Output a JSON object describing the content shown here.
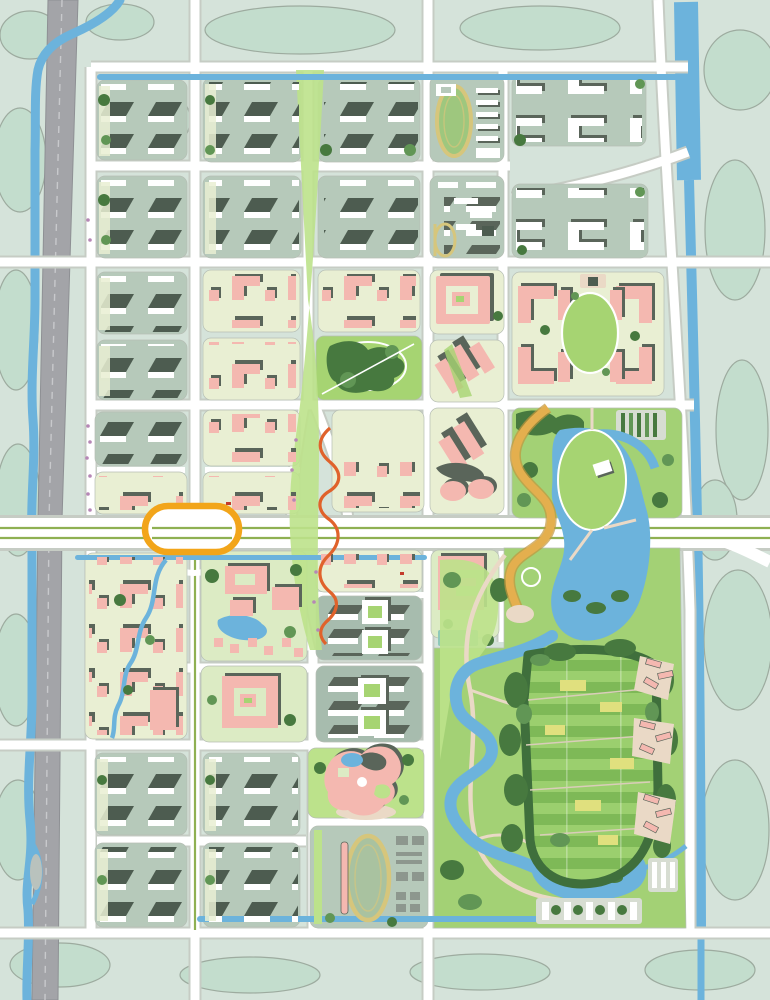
{
  "meta": {
    "title": "Urban district master plan — rendered site plan",
    "type": "site-plan map",
    "image_size": {
      "width": 770,
      "height": 1000
    },
    "visible_text": "none"
  },
  "palette": {
    "bg": "#d5e3da",
    "veg": "#c3ddcd",
    "vegline": "#9dab9f",
    "water": "#6cb3dc",
    "hwy": "#a3a4a8",
    "hwyDash": "#c8c9cc",
    "curb": "#c6ccc4",
    "groundSage": "#b6c9ba",
    "groundPale": "#e9efd3",
    "groundInd": "#a7bcae",
    "groundPark": "#a3d175",
    "groundCampus": "#dcebc4",
    "lawn": "#a6d472",
    "lawnL": "#bce28b",
    "canopy": "#47793f",
    "canopyL": "#619655",
    "slabDark": "#4d5c50",
    "shadow": "#5a655a",
    "pink": "#f4b8b0",
    "treeDark": "#2f4f2e",
    "treeOlive": "#9aa03b",
    "median": "#8fb052",
    "ring": "#f2a51a",
    "sroad": "#e4af4e",
    "sroadEdge": "#c2953c",
    "orange": "#e0622b",
    "track": "#d6c67c",
    "beige": "#ead9c6",
    "gray": "#8d978e",
    "grayLot": "#d7ddd2",
    "farmA": "#7eb957",
    "farmB": "#9bcf6e",
    "farmY": "#e0e07e",
    "pool": "#8fc9b9",
    "purple": "#b687b6"
  },
  "map": {
    "view": "top-down rendered master plan, no labels or legend",
    "districts": [
      {
        "id": "L1-L5",
        "name": "west slab housing estates",
        "kind": "residential-slab",
        "ground": "groundSage"
      },
      {
        "id": "M1-N2",
        "name": "north slab housing estates",
        "kind": "residential-slab",
        "ground": "groundSage"
      },
      {
        "id": "M3-N5",
        "name": "central pink mixed-use blocks",
        "kind": "commercial-pink",
        "ground": "groundPale"
      },
      {
        "id": "N4",
        "name": "central square park",
        "kind": "park",
        "ground": "lawn"
      },
      {
        "id": "P1",
        "name": "school with running track (north)",
        "kind": "institution",
        "ground": "groundSage"
      },
      {
        "id": "P2",
        "name": "school annex with small d-track",
        "kind": "institution",
        "ground": "groundSage"
      },
      {
        "id": "P3",
        "name": "courtyard spiral building block",
        "kind": "civic-pink",
        "ground": "groundPale"
      },
      {
        "id": "P4-P5",
        "name": "diagonal tower blocks with twin cylinders",
        "kind": "civic-pink",
        "ground": "groundPale"
      },
      {
        "id": "Q1-Q2",
        "name": "northeast white courtyard district",
        "kind": "residential-courtyard",
        "ground": "groundSage"
      },
      {
        "id": "Q3",
        "name": "oval-lawn block with pink C-buildings",
        "kind": "civic-pink",
        "ground": "groundPale"
      },
      {
        "id": "Q4",
        "name": "lake park with scenic S-road",
        "kind": "park",
        "ground": "groundPark"
      },
      {
        "id": "L6-L7",
        "name": "southwest dense pink village with creek",
        "kind": "commercial-pink",
        "ground": "groundPale"
      },
      {
        "id": "M7-M8",
        "name": "campus with large pink halls and pond",
        "kind": "campus",
        "ground": "groundCampus"
      },
      {
        "id": "N8-N9",
        "name": "industrial rows with courtyard squares",
        "kind": "industrial",
        "ground": "groundInd"
      },
      {
        "id": "N10",
        "name": "culture center with organic pink building",
        "kind": "civic",
        "ground": "lawnL"
      },
      {
        "id": "N11",
        "name": "south stadium school with track",
        "kind": "institution",
        "ground": "groundSage"
      },
      {
        "id": "P6",
        "name": "U-shaped pink campus building",
        "kind": "campus",
        "ground": "groundCampus"
      },
      {
        "id": "PARK",
        "name": "southeast landscape park with river, lake and farm plots",
        "kind": "park",
        "ground": "groundPark"
      },
      {
        "id": "L8-M10",
        "name": "south slab housing estates",
        "kind": "residential-slab",
        "ground": "groundSage"
      },
      {
        "id": "EDGE",
        "name": "rural fringe parcels with vegetation",
        "kind": "background",
        "ground": "veg"
      }
    ],
    "features": [
      {
        "name": "west-highway",
        "kind": "road",
        "color": "hwy"
      },
      {
        "name": "riverside-stream",
        "kind": "water",
        "color": "water"
      },
      {
        "name": "east-canal",
        "kind": "water",
        "color": "water"
      },
      {
        "name": "block-edge-canals",
        "kind": "water",
        "color": "water"
      },
      {
        "name": "main-boulevard-with-median",
        "kind": "road",
        "color": "median"
      },
      {
        "name": "oval-ring-interchange",
        "kind": "landmark",
        "color": "ring"
      },
      {
        "name": "scenic-s-road",
        "kind": "landmark",
        "color": "sroad"
      },
      {
        "name": "serpentine-trail",
        "kind": "landmark",
        "color": "orange"
      },
      {
        "name": "northeast-arc-road",
        "kind": "road",
        "color": "curb"
      },
      {
        "name": "central-linear-greenway",
        "kind": "park",
        "color": "lawn"
      },
      {
        "name": "lake-with-island-lawn",
        "kind": "water",
        "color": "water"
      },
      {
        "name": "island-pavilion",
        "kind": "building",
        "color": "shadow"
      },
      {
        "name": "farm-plot-grid",
        "kind": "landscape",
        "color": "farmB"
      },
      {
        "name": "running-track-north",
        "kind": "sports",
        "color": "track"
      },
      {
        "name": "running-track-south-with-grandstand",
        "kind": "sports",
        "color": "track"
      },
      {
        "name": "pink-house-clusters",
        "kind": "residential",
        "color": "pink"
      },
      {
        "name": "tree-lined-streets",
        "kind": "planting",
        "color": "treeDark"
      },
      {
        "name": "parking-bosques",
        "kind": "parking",
        "color": "grayLot"
      }
    ]
  }
}
